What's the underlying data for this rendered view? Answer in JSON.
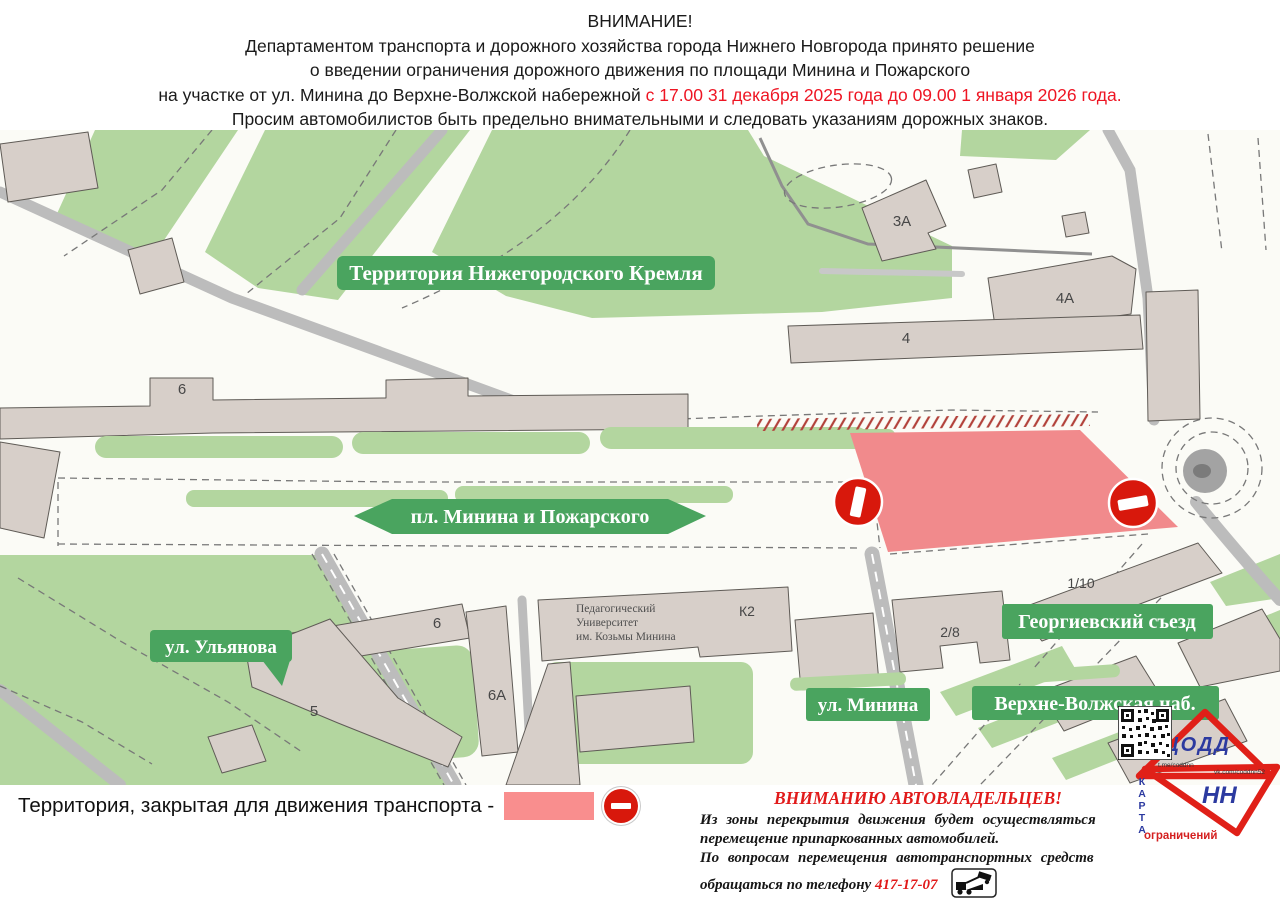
{
  "header": {
    "title": "ВНИМАНИЕ!",
    "line1": "Департаментом транспорта и дорожного хозяйства города Нижнего Новгорода принято решение",
    "line2": "о введении ограничения дорожного движения по площади Минина и Пожарского",
    "line3_black": "на участке от ул. Минина до Верхне-Волжской набережной",
    "line3_red": " с 17.00 31 декабря 2025 года до 09.00 1 января 2026 года.",
    "line4": "Просим автомобилистов быть предельно внимательными и следовать указаниям дорожных знаков."
  },
  "map": {
    "labels": {
      "kremlin": "Территория Нижегородского Кремля",
      "square": "пл. Минина и Пожарского",
      "ulyanova": "ул. Ульянова",
      "minina": "ул. Минина",
      "verhnevolzhskaya": "Верхне-Волжская наб.",
      "georgievsky": "Георгиевский съезд"
    },
    "buildings": {
      "b3a": "3А",
      "b4a": "4А",
      "b4": "4",
      "b6": "6",
      "block6": "6",
      "block6a": "6А",
      "block5": "5",
      "k2": "К2",
      "b28": "2/8",
      "b110": "1/10"
    },
    "university": {
      "l1": "Педагогический",
      "l2": "Университет",
      "l3": "им. Козьмы Минина"
    },
    "colors": {
      "alert_red": "#ee1523",
      "park_green": "#b3d69f",
      "label_green": "#4aa45f",
      "road_gray": "#bcbcbc",
      "building_tan": "#d7cfc9",
      "closed_zone_pink": "#f18a8c",
      "sign_red": "#d8180c",
      "logo_blue": "#2c3aa0",
      "logo_red": "#e02018"
    }
  },
  "legend": {
    "text": "Территория, закрытая для движения транспорта -"
  },
  "notice": {
    "title": "ВНИМАНИЮ АВТОВЛАДЕЛЬЦЕВ!",
    "line1": "Из зоны перекрытия движения будет осуществляться",
    "line2": "перемещение припаркованных автомобилей.",
    "line3": "По вопросам перемещения автотранспортных средств",
    "line4_black": "обращаться по телефону ",
    "phone": "417-17-07"
  },
  "logo": {
    "org": "ЦОДД",
    "city": "НН",
    "telegram": "t.me/coddnn",
    "vk": "vk.com/coddnn52",
    "qr_caption_vertical": "КАРТА",
    "qr_caption_bottom": "ограничений"
  }
}
